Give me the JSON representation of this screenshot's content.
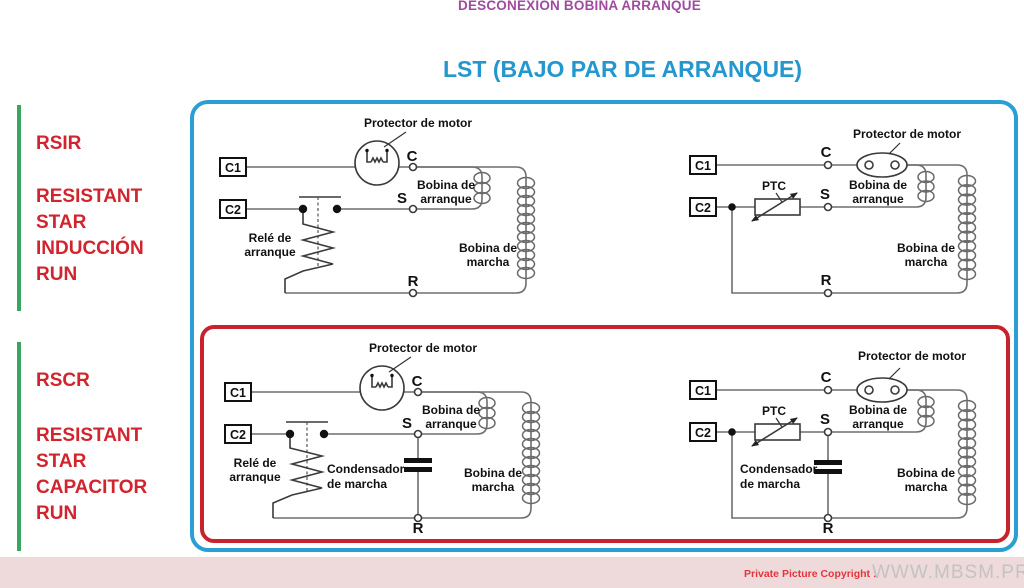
{
  "header": {
    "subtitle": "DESCONEXIÓN BOBINA ARRANQUE",
    "title": "LST (BAJO PAR DE ARRANQUE)"
  },
  "sections": [
    {
      "acronym": "RSIR",
      "expansion_lines": [
        "RESISTANT",
        "STAR",
        "INDUCCIÓN",
        "RUN"
      ]
    },
    {
      "acronym": "RSCR",
      "expansion_lines": [
        "RESISTANT",
        "STAR",
        "CAPACITOR",
        "RUN"
      ]
    }
  ],
  "schematic_labels": {
    "protector": "Protector de motor",
    "bobina_arranque_line1": "Bobina de",
    "bobina_arranque_line2": "arranque",
    "bobina_marcha_line1": "Bobina de",
    "bobina_marcha_line2": "marcha",
    "rele_line1": "Relé de",
    "rele_line2": "arranque",
    "condensador_line1": "Condensador",
    "condensador_line2": "de marcha",
    "ptc": "PTC",
    "c1": "C1",
    "c2": "C2",
    "terminal_c": "C",
    "terminal_s": "S",
    "terminal_r": "R"
  },
  "circuits": [
    {
      "id": "rsir-relay",
      "row": "RSIR",
      "start_device": "Relé de arranque",
      "terminals": [
        "C1",
        "C2",
        "C",
        "S",
        "R"
      ],
      "components": [
        "Protector de motor",
        "Relé de arranque",
        "Bobina de arranque",
        "Bobina de marcha"
      ]
    },
    {
      "id": "rsir-ptc",
      "row": "RSIR",
      "start_device": "PTC",
      "terminals": [
        "C1",
        "C2",
        "C",
        "S",
        "R"
      ],
      "components": [
        "Protector de motor",
        "PTC",
        "Bobina de arranque",
        "Bobina de marcha"
      ]
    },
    {
      "id": "rscr-relay",
      "row": "RSCR",
      "start_device": "Relé de arranque",
      "terminals": [
        "C1",
        "C2",
        "C",
        "S",
        "R"
      ],
      "components": [
        "Protector de motor",
        "Relé de arranque",
        "Condensador de marcha",
        "Bobina de arranque",
        "Bobina de marcha"
      ]
    },
    {
      "id": "rscr-ptc",
      "row": "RSCR",
      "start_device": "PTC",
      "terminals": [
        "C1",
        "C2",
        "C",
        "S",
        "R"
      ],
      "components": [
        "Protector de motor",
        "PTC",
        "Condensador de marcha",
        "Bobina de arranque",
        "Bobina de marcha"
      ]
    }
  ],
  "footer": {
    "copyright_label": "Private Picture Copyright :",
    "site": "WWW.MBSM.PRO"
  },
  "colors": {
    "title_purple": "#a04aa0",
    "title_blue": "#2497cf",
    "frame_blue": "#2b9fd3",
    "frame_red": "#c8232c",
    "section_red": "#d2242e",
    "green_bar": "#3aa55c",
    "footer_background": "#eedada",
    "footer_site_gray": "#c4c3c3",
    "wire_gray": "#6e6e6e"
  }
}
